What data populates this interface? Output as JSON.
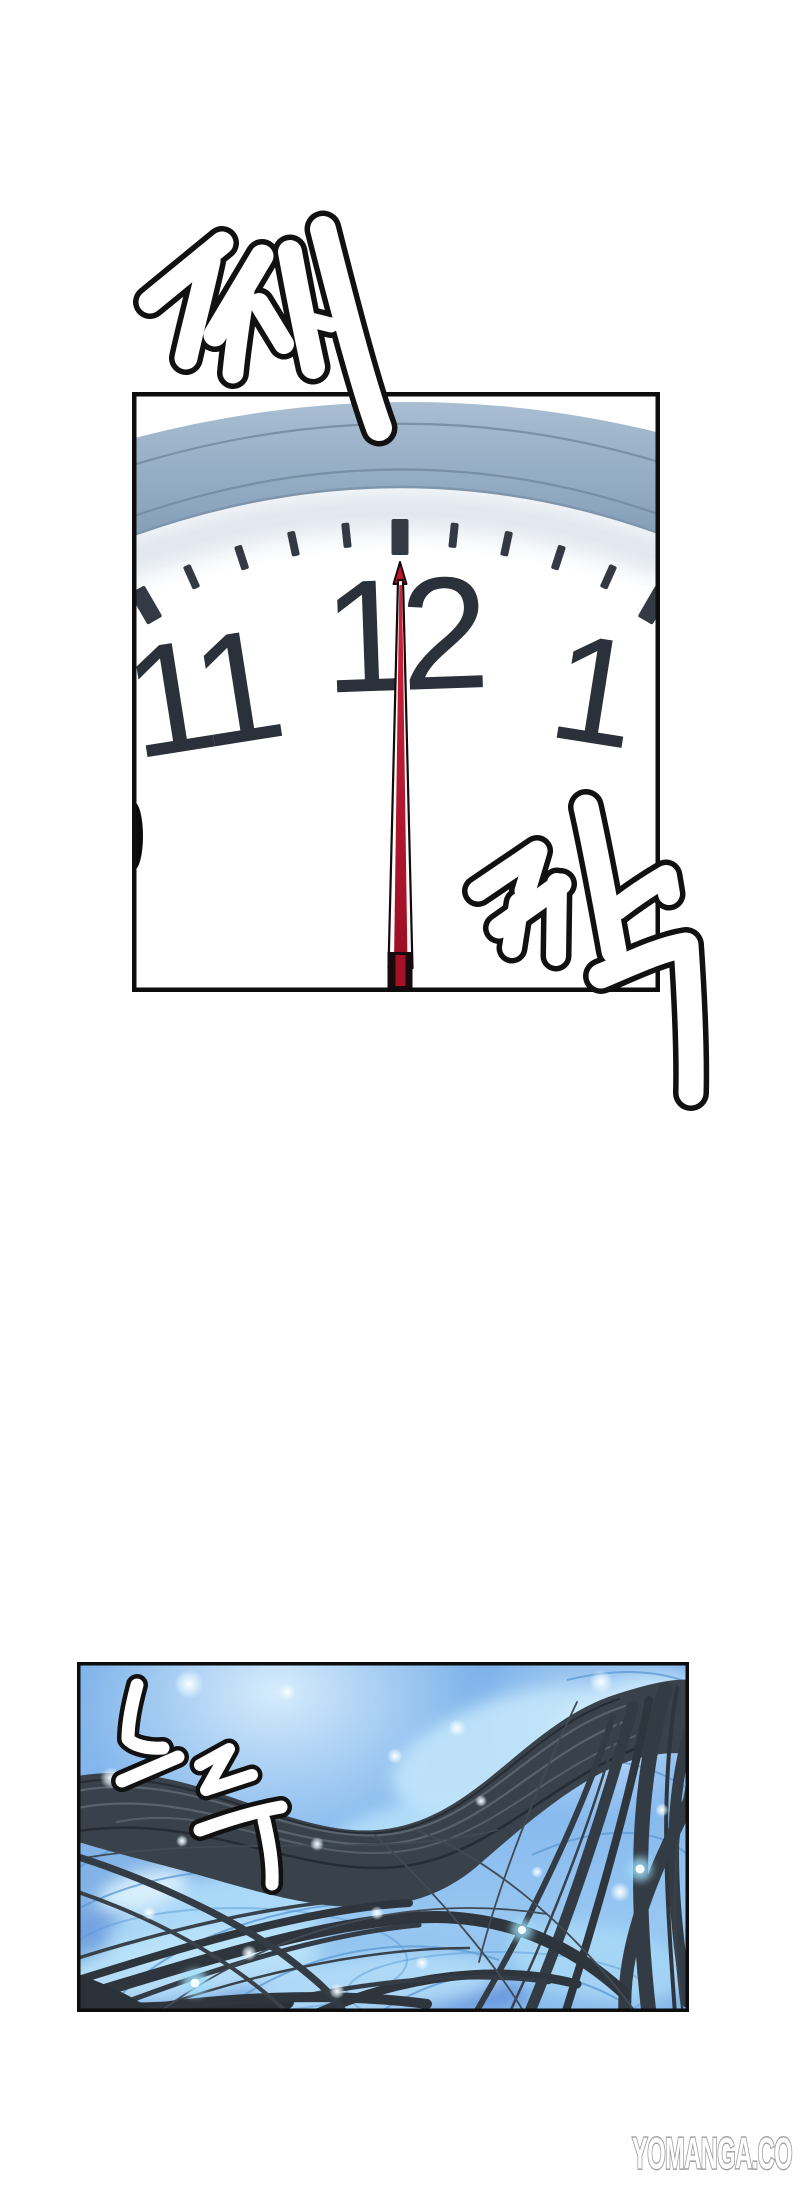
{
  "page": {
    "width": 800,
    "height": 2189,
    "background": "#ffffff"
  },
  "panels": [
    {
      "id": "clock-panel",
      "description": "clock face at 12 o'clock"
    },
    {
      "id": "water-panel",
      "description": "underwater scene with flowing hair"
    }
  ],
  "clock": {
    "numbers": [
      "11",
      "12",
      "1"
    ]
  },
  "sfx": [
    {
      "text": "째"
    },
    {
      "text": "깍"
    },
    {
      "text": "스륵"
    }
  ],
  "watermark": {
    "text": "YOMANGA.CO"
  },
  "colors": {
    "panel_border": "#0d0d0d",
    "second_hand_red": "#c2142c",
    "clock_rim_blue": "#92abc3",
    "clock_number": "#2b313a",
    "water_blue": "#79afe9",
    "caustic_light": "#bce4fa",
    "hair_dark": "#39414a",
    "sfx_fill": "#ffffff",
    "sfx_outline": "#111111",
    "watermark_outline": "#9a9a9a"
  }
}
